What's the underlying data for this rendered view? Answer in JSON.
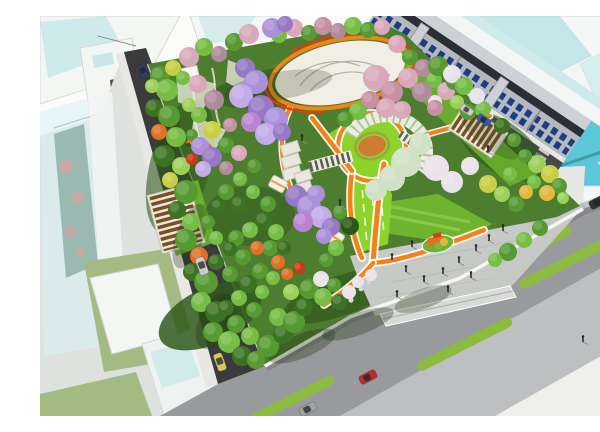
{
  "meta": {
    "title": "Aerial rendering of urban park master plan",
    "description": "Bird's-eye architectural rendering: diamond-shaped city park with flowering trees, white event plaza with orange ring, spiral pergola garden, orange pathways, south entrance plaza with pedestrians, bounded by an asphalt street, a wide boulevard with green median strips and cars, shop-house row and translucent glass towers."
  },
  "colors": {
    "bg": "#fbfbfa",
    "khaki": "#b6b68e",
    "glass_white": "#f3f6f5",
    "glass_teal": "#aadde2",
    "glass_teal_deep": "#49c3d6",
    "glass_edge": "#d2dcdb",
    "shop_face": "#b5b9bf",
    "shop_face_light": "#cdd1d5",
    "shop_win": "#1d3d82",
    "shop_roof": "#2b2f35",
    "shop_divider": "#888c92",
    "road_dark": "#3b3b3d",
    "road_mid": "#47494d",
    "road_light": "#989a9d",
    "road_overlay": "#dddedf",
    "sidewalk": "#e7e7e3",
    "curb": "#f6f6f2",
    "median": "#8cbb40",
    "base_left": "#dfe1df",
    "bld_white": "#f4f6f4",
    "bld_edge": "#d5d9d6",
    "lawn_strip": "#a3bb82",
    "park_base": "#4d7d2f",
    "park_dark": "#31591d",
    "lawn_bright": "#8ed32b",
    "lawn_mid": "#6fb42e",
    "plaza": "#f1eee5",
    "plaza_line": "#b7b2a2",
    "ring_orange": "#f38316",
    "ring_red": "#e83a0e",
    "path_edge": "#ffffff",
    "entr": "#c6c9c6",
    "entr_light": "#d8dad7",
    "entr_dark": "#b0b3b0",
    "pergola_frame": "#eae7e0",
    "pergola_slat": "#7b5020",
    "arc_frame": "#eaeedd",
    "arc_rib": "#7e906b",
    "flower_center": "#cf7a35",
    "flower_ring": "#97a83e",
    "tent": "#e17028",
    "rock": "#dcdcd4",
    "tree_g1": "#3c7322",
    "tree_g2": "#579a31",
    "tree_g3": "#76bd45",
    "tree_g4": "#9bd158",
    "tree_g5": "#2c5618",
    "tree_y1": "#c9cf45",
    "tree_y2": "#e2b93c",
    "tree_pk": "#d9a8ba",
    "tree_pk2": "#c78fa4",
    "tree_mv": "#b18a9b",
    "tree_pu1": "#9678c6",
    "tree_pu2": "#ab90da",
    "tree_pu3": "#c3abe9",
    "tree_mg": "#bb83d2",
    "tree_or": "#e07028",
    "tree_rd": "#c93818",
    "tree_wb": "#eae3ea",
    "tree_wg": "#d0e1c5",
    "car_silver": "#c9cbcd",
    "car_navy": "#2d3d6e",
    "car_taxi": "#d9c95b",
    "car_red": "#b5302a",
    "car_blue": "#3a59b2",
    "car_gray": "#9fa3a6",
    "car_dark": "#32363a",
    "person": "#2b2b2b",
    "shadow": "#1f3313"
  },
  "scene": {
    "trees": [
      [
        120,
        60,
        10,
        "g2"
      ],
      [
        133,
        52,
        8,
        "y1"
      ],
      [
        127,
        74,
        11,
        "g3"
      ],
      [
        114,
        92,
        9,
        "g1"
      ],
      [
        129,
        100,
        11,
        "g2"
      ],
      [
        119,
        116,
        8,
        "or"
      ],
      [
        136,
        121,
        10,
        "g3"
      ],
      [
        124,
        140,
        11,
        "g1"
      ],
      [
        141,
        150,
        9,
        "g4"
      ],
      [
        130,
        164,
        8,
        "y1"
      ],
      [
        146,
        176,
        12,
        "g2"
      ],
      [
        137,
        194,
        9,
        "g1"
      ],
      [
        151,
        206,
        9,
        "g3"
      ],
      [
        146,
        224,
        11,
        "g2"
      ],
      [
        159,
        240,
        9,
        "or"
      ],
      [
        152,
        256,
        9,
        "g1"
      ],
      [
        166,
        266,
        12,
        "g2"
      ],
      [
        161,
        286,
        10,
        "g3"
      ],
      [
        176,
        296,
        11,
        "g1"
      ],
      [
        173,
        316,
        10,
        "g2"
      ],
      [
        189,
        326,
        11,
        "g3"
      ],
      [
        202,
        340,
        10,
        "g1"
      ],
      [
        216,
        344,
        9,
        "g2"
      ],
      [
        112,
        70,
        7,
        "g4"
      ],
      [
        149,
        41,
        10,
        "pk"
      ],
      [
        164,
        31,
        9,
        "g3"
      ],
      [
        179,
        38,
        8,
        "mv"
      ],
      [
        194,
        26,
        9,
        "g2"
      ],
      [
        209,
        18,
        10,
        "pk"
      ],
      [
        239,
        19,
        8,
        "g3"
      ],
      [
        254,
        12,
        9,
        "pk"
      ],
      [
        269,
        17,
        8,
        "g2"
      ],
      [
        283,
        10,
        9,
        "pk2"
      ],
      [
        298,
        15,
        8,
        "mv"
      ],
      [
        313,
        10,
        9,
        "g3"
      ],
      [
        328,
        14,
        8,
        "g2"
      ],
      [
        342,
        11,
        8,
        "pk"
      ],
      [
        357,
        28,
        9,
        "pk"
      ],
      [
        370,
        41,
        8,
        "g2"
      ],
      [
        383,
        52,
        9,
        "mv"
      ],
      [
        394,
        64,
        8,
        "g3"
      ],
      [
        406,
        75,
        9,
        "pk"
      ],
      [
        417,
        86,
        7,
        "g4"
      ],
      [
        428,
        96,
        8,
        "g2"
      ],
      [
        395,
        86,
        7,
        "wb"
      ],
      [
        380,
        74,
        7,
        "g4"
      ],
      [
        497,
        148,
        9,
        "g4"
      ],
      [
        510,
        158,
        9,
        "y1"
      ],
      [
        519,
        170,
        8,
        "g2"
      ],
      [
        507,
        177,
        8,
        "y2"
      ],
      [
        494,
        166,
        7,
        "g3"
      ],
      [
        485,
        140,
        7,
        "g2"
      ],
      [
        523,
        182,
        6,
        "g4"
      ],
      [
        414,
        66,
        8,
        "g2"
      ],
      [
        443,
        93,
        8,
        "g3"
      ],
      [
        462,
        110,
        8,
        "g1"
      ],
      [
        474,
        124,
        7,
        "g2"
      ],
      [
        228,
        330,
        11,
        "g2"
      ],
      [
        243,
        318,
        10,
        "g1"
      ],
      [
        238,
        301,
        9,
        "g3"
      ],
      [
        254,
        306,
        11,
        "g2"
      ],
      [
        264,
        291,
        9,
        "g1"
      ],
      [
        251,
        276,
        8,
        "g4"
      ],
      [
        269,
        273,
        10,
        "g2"
      ],
      [
        283,
        281,
        9,
        "g3"
      ],
      [
        281,
        263,
        8,
        "wb"
      ],
      [
        294,
        269,
        7,
        "g2"
      ],
      [
        299,
        286,
        8,
        "g1"
      ],
      [
        309,
        276,
        7,
        "wb"
      ],
      [
        318,
        266,
        6,
        "wb"
      ],
      [
        331,
        259,
        6,
        "wb"
      ],
      [
        210,
        320,
        9,
        "g3"
      ],
      [
        196,
        308,
        9,
        "g2"
      ],
      [
        186,
        292,
        8,
        "g1"
      ],
      [
        199,
        282,
        8,
        "g3"
      ],
      [
        214,
        294,
        8,
        "g2"
      ],
      [
        208,
        268,
        9,
        "g1"
      ],
      [
        222,
        276,
        7,
        "g3"
      ],
      [
        190,
        258,
        8,
        "g2"
      ],
      [
        176,
        246,
        8,
        "g1"
      ],
      [
        220,
        255,
        8,
        "g2"
      ],
      [
        233,
        262,
        7,
        "g3"
      ],
      [
        247,
        258,
        6,
        "or"
      ],
      [
        259,
        252,
        6,
        "rd"
      ],
      [
        238,
        246,
        7,
        "or"
      ],
      [
        158,
        68,
        9,
        "pk"
      ],
      [
        174,
        84,
        10,
        "mv"
      ],
      [
        159,
        99,
        8,
        "g3"
      ],
      [
        172,
        114,
        9,
        "y1"
      ],
      [
        186,
        129,
        8,
        "g2"
      ],
      [
        166,
        134,
        7,
        "or"
      ],
      [
        149,
        89,
        7,
        "g4"
      ],
      [
        190,
        109,
        7,
        "pk2"
      ],
      [
        152,
        119,
        6,
        "g2"
      ],
      [
        199,
        137,
        8,
        "pk"
      ],
      [
        214,
        150,
        7,
        "g2"
      ],
      [
        186,
        152,
        7,
        "mv"
      ],
      [
        200,
        163,
        7,
        "g3"
      ],
      [
        152,
        143,
        6,
        "rd"
      ],
      [
        143,
        62,
        7,
        "g3"
      ],
      [
        186,
        176,
        8,
        "g2"
      ],
      [
        199,
        188,
        8,
        "g1"
      ],
      [
        213,
        176,
        7,
        "g3"
      ],
      [
        228,
        188,
        8,
        "g2"
      ],
      [
        224,
        205,
        9,
        "g1"
      ],
      [
        210,
        214,
        8,
        "g3"
      ],
      [
        196,
        222,
        8,
        "g2"
      ],
      [
        236,
        216,
        8,
        "g3"
      ],
      [
        230,
        232,
        8,
        "g2"
      ],
      [
        244,
        232,
        7,
        "g1"
      ],
      [
        217,
        232,
        7,
        "or"
      ],
      [
        203,
        241,
        8,
        "g2"
      ],
      [
        190,
        233,
        7,
        "g1"
      ],
      [
        176,
        222,
        7,
        "g3"
      ],
      [
        168,
        206,
        7,
        "g2"
      ],
      [
        178,
        190,
        7,
        "g1"
      ],
      [
        296,
        232,
        8,
        "g3"
      ],
      [
        286,
        244,
        7,
        "g2"
      ],
      [
        310,
        210,
        9,
        "g5"
      ],
      [
        300,
        196,
        7,
        "g2"
      ],
      [
        468,
        236,
        9,
        "g2"
      ],
      [
        484,
        224,
        8,
        "g3"
      ],
      [
        500,
        212,
        8,
        "g2"
      ],
      [
        455,
        244,
        7,
        "g3"
      ],
      [
        448,
        168,
        9,
        "y1"
      ],
      [
        462,
        178,
        8,
        "g4"
      ],
      [
        476,
        188,
        8,
        "g2"
      ],
      [
        486,
        176,
        7,
        "y2"
      ],
      [
        470,
        158,
        7,
        "g3"
      ],
      [
        398,
        50,
        10,
        "g2"
      ],
      [
        412,
        58,
        9,
        "wb"
      ],
      [
        424,
        70,
        9,
        "g3"
      ],
      [
        437,
        80,
        8,
        "wb"
      ],
      [
        336,
        62,
        13,
        "pk"
      ],
      [
        352,
        76,
        11,
        "pk2"
      ],
      [
        368,
        62,
        10,
        "pk"
      ],
      [
        382,
        76,
        10,
        "mv"
      ],
      [
        346,
        92,
        10,
        "pk"
      ],
      [
        330,
        84,
        9,
        "pk2"
      ],
      [
        362,
        94,
        9,
        "pk"
      ],
      [
        395,
        92,
        8,
        "pk2"
      ],
      [
        318,
        95,
        9,
        "g3"
      ],
      [
        305,
        103,
        8,
        "g2"
      ],
      [
        366,
        146,
        15,
        "wg"
      ],
      [
        352,
        162,
        13,
        "wg"
      ],
      [
        336,
        174,
        11,
        "wg"
      ],
      [
        380,
        128,
        11,
        "wg"
      ],
      [
        396,
        152,
        13,
        "wb"
      ],
      [
        412,
        166,
        11,
        "wb"
      ],
      [
        430,
        150,
        9,
        "wb"
      ],
      [
        232,
        12,
        10,
        "pu2"
      ],
      [
        245,
        8,
        8,
        "pu1"
      ],
      [
        205,
        52,
        10,
        "pu1"
      ],
      [
        216,
        66,
        12,
        "pu2"
      ],
      [
        201,
        80,
        12,
        "pu3"
      ],
      [
        221,
        92,
        13,
        "pu1"
      ],
      [
        236,
        103,
        12,
        "pu2"
      ],
      [
        211,
        106,
        10,
        "mg"
      ],
      [
        226,
        118,
        11,
        "pu3"
      ],
      [
        242,
        116,
        9,
        "pu1"
      ],
      [
        160,
        130,
        9,
        "pu2"
      ],
      [
        172,
        141,
        10,
        "pu1"
      ],
      [
        163,
        153,
        8,
        "pu3"
      ],
      [
        256,
        180,
        11,
        "pu1"
      ],
      [
        269,
        191,
        12,
        "pu2"
      ],
      [
        281,
        201,
        11,
        "pu3"
      ],
      [
        263,
        206,
        10,
        "mg"
      ],
      [
        276,
        178,
        9,
        "pu2"
      ],
      [
        291,
        211,
        9,
        "pu1"
      ],
      [
        284,
        220,
        8,
        "pu2"
      ]
    ],
    "cars": [
      {
        "x": 162,
        "y": 250,
        "rot": 70,
        "color": "silver"
      },
      {
        "x": 103,
        "y": 55,
        "rot": 70,
        "color": "navy",
        "s": 0.8
      },
      {
        "x": 180,
        "y": 346,
        "rot": 70,
        "color": "taxi"
      },
      {
        "x": 328,
        "y": 361,
        "rot": -27,
        "color": "red"
      },
      {
        "x": 268,
        "y": 393,
        "rot": -27,
        "color": "gray"
      },
      {
        "x": 570,
        "y": 278,
        "rot": -27,
        "color": "blue"
      },
      {
        "x": 558,
        "y": 186,
        "rot": -27,
        "color": "dark"
      },
      {
        "x": 444,
        "y": 104,
        "rot": 34,
        "color": "blue",
        "s": 0.8
      },
      {
        "x": 427,
        "y": 94,
        "rot": 34,
        "color": "silver",
        "s": 0.75
      }
    ],
    "people": [
      [
        352,
        244
      ],
      [
        366,
        256
      ],
      [
        384,
        266
      ],
      [
        403,
        258
      ],
      [
        419,
        247
      ],
      [
        436,
        235
      ],
      [
        449,
        225
      ],
      [
        372,
        231
      ],
      [
        408,
        276
      ],
      [
        357,
        281
      ],
      [
        431,
        262
      ],
      [
        463,
        215
      ],
      [
        567,
        156
      ],
      [
        579,
        166
      ],
      [
        543,
        326
      ],
      [
        448,
        136
      ],
      [
        300,
        190
      ],
      [
        262,
        125
      ]
    ],
    "medians": [
      {
        "x": 378,
        "y": 352,
        "len": 105,
        "rot": -27
      },
      {
        "x": 480,
        "y": 270,
        "len": 95,
        "rot": -27
      },
      {
        "x": 212,
        "y": 404,
        "len": 92,
        "rot": -27
      },
      {
        "x": 452,
        "y": 256,
        "len": 90,
        "rot": -29
      }
    ]
  }
}
